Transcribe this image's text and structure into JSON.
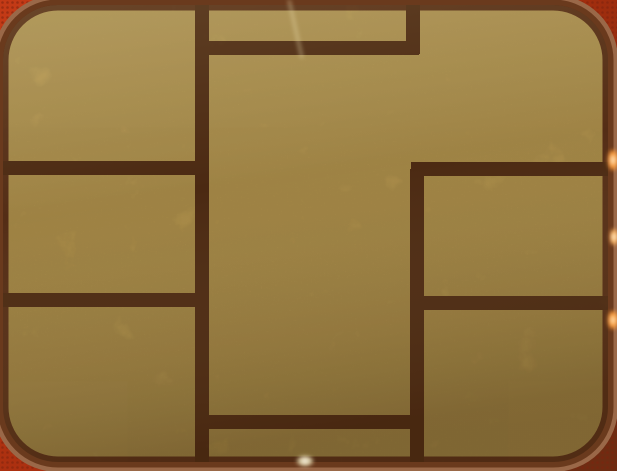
{
  "scene": {
    "title": "Macro photograph of a gold smart-card chip (EMV/SIM contact plate) on a red card body",
    "object": "smart-card-chip-contact-plate",
    "background": "red card body with halftone texture, visible at the four rounded corners",
    "pads": [
      "top-left-contact",
      "middle-left-contact",
      "bottom-left-contact",
      "top-center-contact",
      "center-contact",
      "bottom-center-contact",
      "top-right-contact",
      "middle-right-contact",
      "bottom-right-contact"
    ]
  },
  "palette": {
    "gold": "#c4a153",
    "gold_light": "#d0b065",
    "gold_dark": "#b0914a",
    "trace": "#5e3418",
    "border": "#6a3a1d",
    "border_rim": "#9a6848",
    "card_red": "#c33a16",
    "card_red_dark": "#a42d0e",
    "card_maroon": "#6e2c12",
    "card_dot": "#7e230c",
    "scratch": "#e9dbac"
  },
  "geometry": {
    "canvas": {
      "width": 617,
      "height": 471
    },
    "chip": {
      "x": 3,
      "y": 5,
      "width": 605,
      "height": 457,
      "radius": 55,
      "border_width": 11,
      "rim_width": 20
    },
    "trace_width": 14,
    "traces": [
      {
        "name": "center-left-vertical",
        "x1": 202,
        "y1": 5,
        "x2": 202,
        "y2": 462
      },
      {
        "name": "top-notch-vertical",
        "x1": 413,
        "y1": 5,
        "x2": 413,
        "y2": 54
      },
      {
        "name": "top-notch-horizontal",
        "x1": 202,
        "y1": 48,
        "x2": 419,
        "y2": 48
      },
      {
        "name": "left-upper-horizontal",
        "x1": -6,
        "y1": 168,
        "x2": 202,
        "y2": 168
      },
      {
        "name": "right-upper-horizontal",
        "x1": 411,
        "y1": 169,
        "x2": 612,
        "y2": 169
      },
      {
        "name": "right-column-vertical",
        "x1": 417,
        "y1": 169,
        "x2": 417,
        "y2": 462
      },
      {
        "name": "left-lower-horizontal",
        "x1": -6,
        "y1": 300,
        "x2": 202,
        "y2": 300
      },
      {
        "name": "right-lower-horizontal",
        "x1": 411,
        "y1": 303,
        "x2": 612,
        "y2": 303
      },
      {
        "name": "bottom-center-horizontal",
        "x1": 202,
        "y1": 422,
        "x2": 417,
        "y2": 422
      }
    ],
    "glints": [
      {
        "name": "right-edge-glint-upper",
        "cx": 613,
        "cy": 160,
        "rx": 5,
        "ry": 10,
        "color": "#ff9d3a",
        "core": "#ffe9c2"
      },
      {
        "name": "right-edge-glint-middle",
        "cx": 614,
        "cy": 237,
        "rx": 4,
        "ry": 8,
        "color": "#ffb45e",
        "core": "#fff3d8"
      },
      {
        "name": "right-edge-glint-lower",
        "cx": 613,
        "cy": 320,
        "rx": 5,
        "ry": 9,
        "color": "#ff9d3a",
        "core": "#ffe2b2"
      },
      {
        "name": "bottom-edge-glint",
        "cx": 305,
        "cy": 461,
        "rx": 8,
        "ry": 5,
        "color": "#d8c9a0",
        "core": "#f6efdd"
      }
    ],
    "scratch": {
      "x1": 289,
      "y1": 0,
      "x2": 302,
      "y2": 58
    }
  }
}
